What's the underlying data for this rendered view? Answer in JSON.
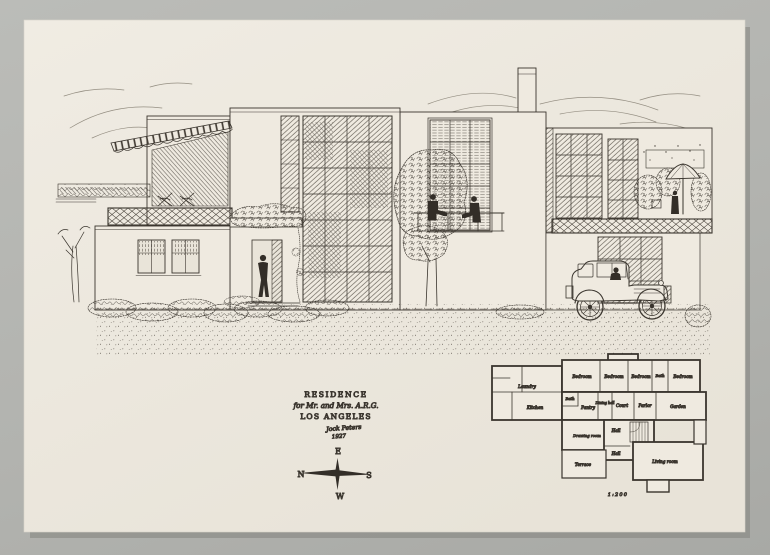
{
  "title_block": {
    "line1": "RESIDENCE",
    "line2": "for Mr. and Mrs. A.R.G.",
    "line3": "LOS ANGELES",
    "signature": "Jock Peters",
    "year": "1927"
  },
  "compass": {
    "top": "E",
    "left": "N",
    "right": "S",
    "bottom": "W"
  },
  "floor_plan": {
    "scale_label": "1:200",
    "rooms": [
      "Laundry",
      "Kitchen",
      "Bedroom",
      "Bedroom",
      "Bedroom",
      "Bath",
      "Bedroom",
      "Bath",
      "Pantry",
      "Dining hall",
      "Court",
      "Parlor",
      "Garden",
      "Drawing room",
      "Hall",
      "Hall",
      "Terrace",
      "Living room"
    ]
  },
  "colors": {
    "paper": "#ece7dd",
    "ink": "#3a352e",
    "mount": "#b2b3af"
  }
}
